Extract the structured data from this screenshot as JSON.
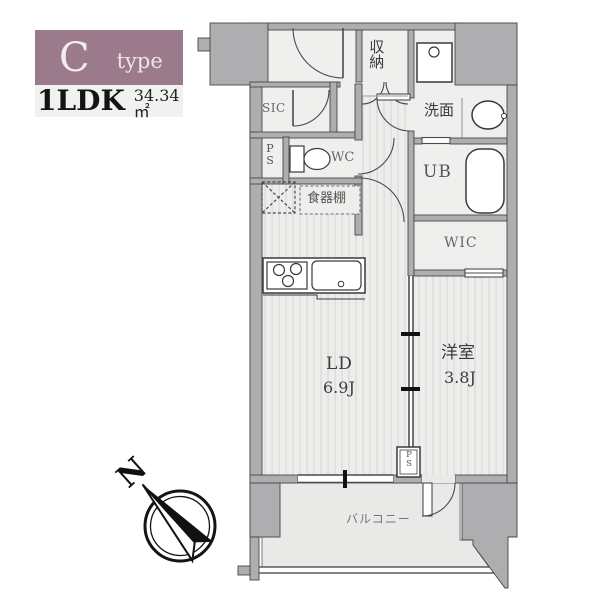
{
  "header": {
    "type_letter": "C",
    "type_word": "type",
    "layout": "1LDK",
    "area": "34.34㎡"
  },
  "labels": {
    "storage": "収納",
    "sic": "SIC",
    "ps_upper": "PS",
    "wc": "WC",
    "cupboard": "食器棚",
    "washroom": "洗面",
    "unit_bath": "UB",
    "wic": "WIC",
    "living_dining": "LD",
    "living_dining_size": "6.9J",
    "western_room": "洋室",
    "western_room_size": "3.8J",
    "balcony": "バルコニー",
    "ps_lower": "PS",
    "north": "N"
  },
  "colors": {
    "accent_mauve": "#9a7a8b",
    "wall_gray": "#aeaeb1",
    "floor_light": "#efefed",
    "floor_stripe": "#dbdbd9",
    "balcony_floor": "#e9e9e7",
    "line_dark": "#47474a"
  }
}
